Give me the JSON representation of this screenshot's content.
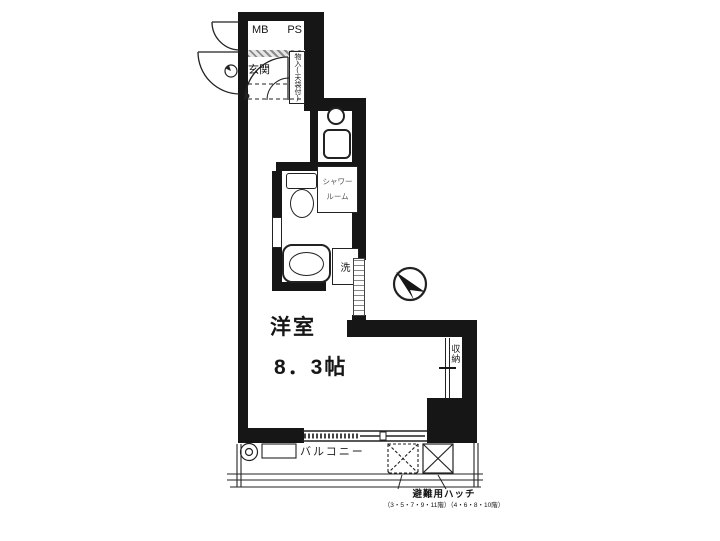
{
  "title": "apartment-floorplan",
  "labels": {
    "mb": "MB",
    "ps": "PS",
    "entrance": "玄関",
    "storage_top": "物入(天袋付)",
    "shower_line1": "シャワー",
    "shower_line2": "ルーム",
    "washer": "洗",
    "room_name": "洋室",
    "room_size": "8．3帖",
    "closet": "収納",
    "balcony": "バルコニー",
    "escape_hatch": "避難用ハッチ",
    "escape_hatch_floors": "（3・5・7・9・11階）（4・6・8・10階）"
  },
  "colors": {
    "wall": "#161616",
    "line": "#333333",
    "background": "#ffffff"
  }
}
